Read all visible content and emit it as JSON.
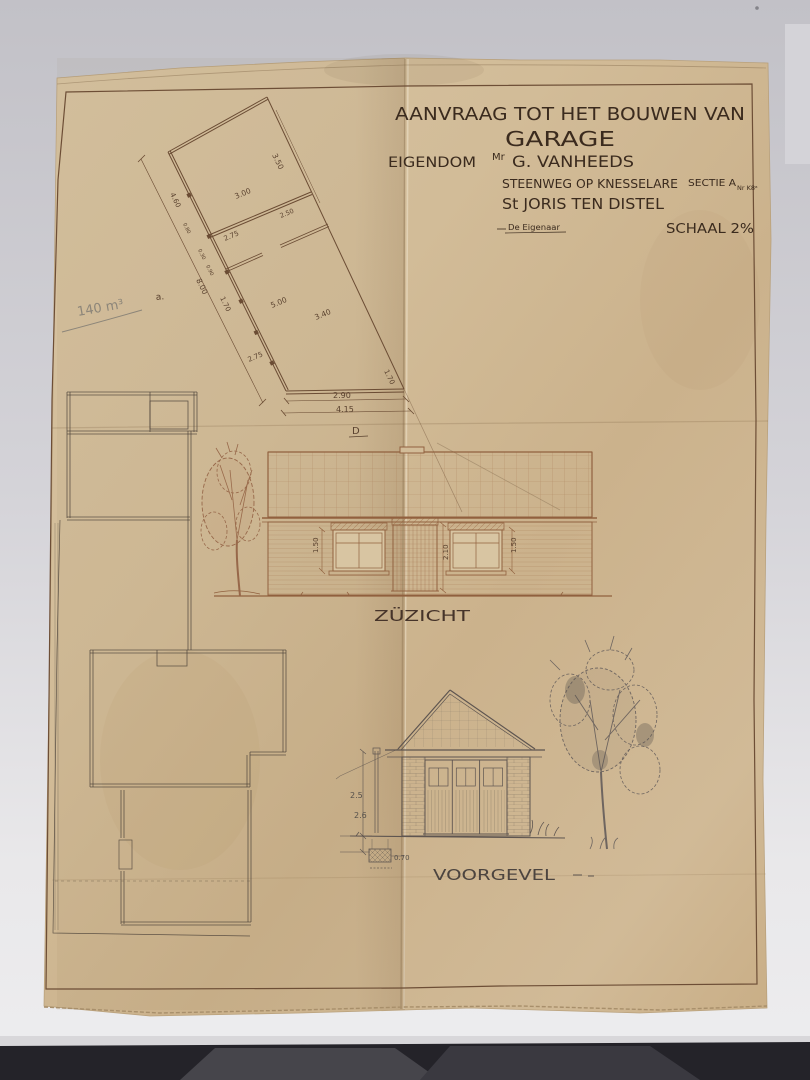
{
  "title_block": {
    "line1": "AANVRAAG TOT HET BOUWEN VAN",
    "line2": "GARAGE",
    "owner_label": "EIGENDOM",
    "owner_title": "Mr",
    "owner_name": "G. VANHEEDS",
    "street": "STEENWEG OP KNESSELARE",
    "section": "SECTIE A",
    "section_no": "Nr K8ᵃ",
    "locality": "St JORIS TEN DISTEL",
    "signature_label": "De Eigenaar",
    "scale_label": "SCHAAL 2%"
  },
  "site_plan": {
    "volume_note": "140 m³",
    "point_label_a": "a.",
    "point_label_d": "D",
    "dims": {
      "d350": "3.50",
      "d300": "3.00",
      "d250": "2.50",
      "d275a": "2.75",
      "d500": "5.00",
      "d340": "3.40",
      "d275b": "2.75",
      "d170a": "1.70",
      "d170b": "1.70",
      "d800": "8.00",
      "d460": "4.60",
      "d080": "0.80",
      "d030": "0.30",
      "d090": "0.90",
      "d290": "2.90",
      "d415": "4.15"
    }
  },
  "side_elevation": {
    "label": "ZÜZICHT",
    "dim_window_left": "1.50",
    "dim_door": "2.10",
    "dim_window_right": "1.50"
  },
  "front_elevation": {
    "label": "VOORGEVEL",
    "dim_height_upper": "2.5",
    "dim_height_lower": "2.6",
    "dim_foundation": "0.70"
  },
  "colors": {
    "paper": "#cfb692",
    "ink": "#3b2b1e",
    "elevation_ink": "#91613f",
    "pencil": "#5a524a",
    "background": "#c6c5ca"
  }
}
